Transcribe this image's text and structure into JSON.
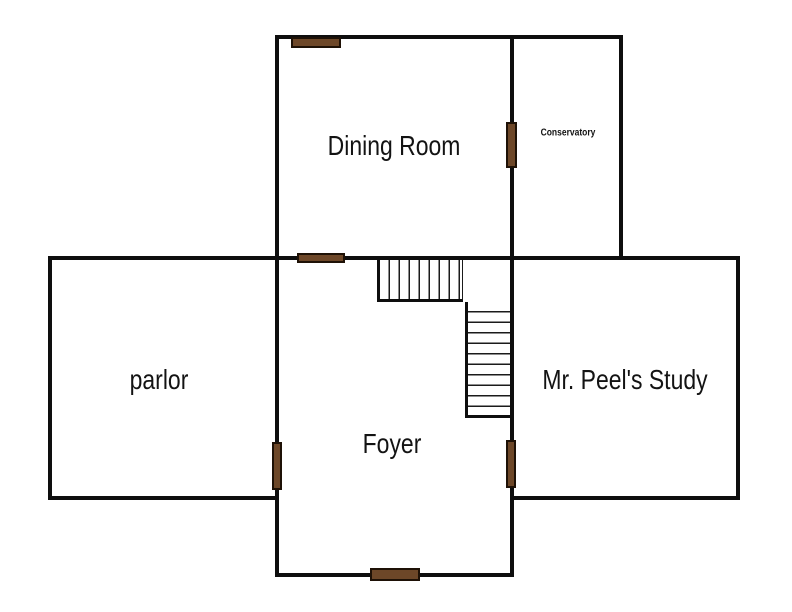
{
  "colors": {
    "background": "#ffffff",
    "wall": "#0e0e0e",
    "stair_line": "#1b1b1b",
    "door": "#6d4728",
    "door_border": "#1e1106",
    "text": "#131313"
  },
  "rooms": {
    "dining": {
      "label": "Dining Room"
    },
    "conservatory": {
      "label": "Conservatory"
    },
    "parlor": {
      "label": "parlor"
    },
    "study": {
      "label": "Mr. Peel's Study"
    },
    "foyer": {
      "label": "Foyer"
    }
  }
}
